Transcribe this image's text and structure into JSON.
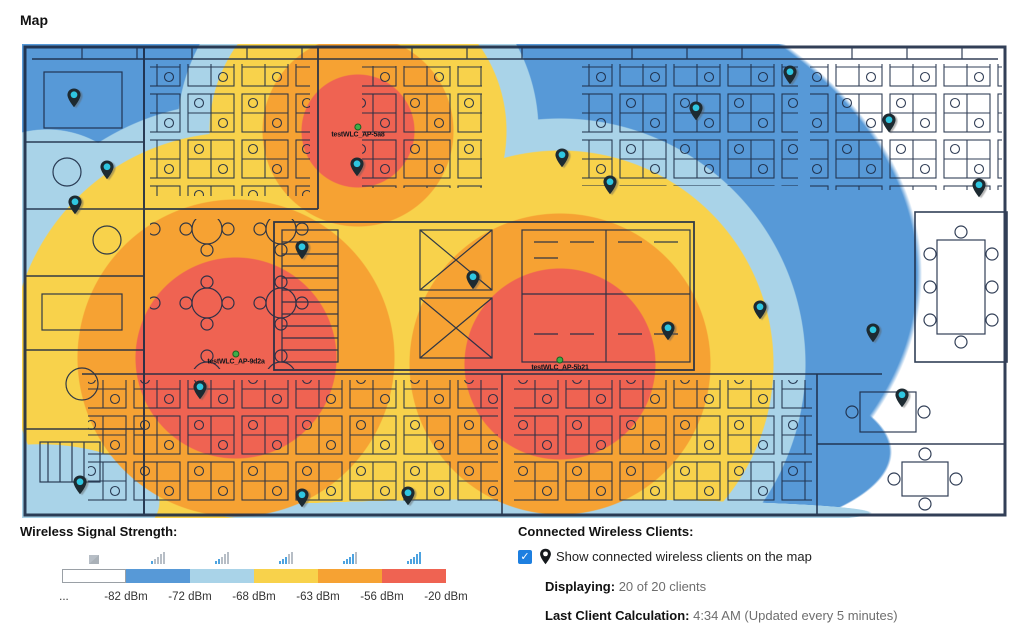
{
  "page": {
    "title": "Map"
  },
  "legend": {
    "title": "Wireless Signal Strength:",
    "leading_label": "...",
    "segments": [
      {
        "color": "#ffffff",
        "label": "-82 dBm",
        "bars": 0
      },
      {
        "color": "#5799d7",
        "label": "-72 dBm",
        "bars": 1
      },
      {
        "color": "#a9d3e8",
        "label": "-68 dBm",
        "bars": 2
      },
      {
        "color": "#f8d24b",
        "label": "-63 dBm",
        "bars": 3
      },
      {
        "color": "#f6a233",
        "label": "-56 dBm",
        "bars": 4
      },
      {
        "color": "#ef6352",
        "label": "-20 dBm",
        "bars": 5
      }
    ]
  },
  "clients_panel": {
    "title": "Connected Wireless Clients:",
    "checkbox_checked": true,
    "checkbox_glyph": "✓",
    "checkbox_label": "Show connected wireless clients on the map",
    "displaying_label": "Displaying:",
    "displaying_value": "20 of 20 clients",
    "last_calc_label": "Last Client Calculation:",
    "last_calc_value": "4:34 AM (Updated every 5 minutes)"
  },
  "map": {
    "heat_colors": {
      "blue": "#5799d7",
      "light_blue": "#a9d3e8",
      "yellow": "#f8d24b",
      "orange": "#f6a233",
      "red": "#ef6352"
    },
    "access_points": [
      {
        "name": "testWLC_AP-5a8",
        "x": 336,
        "y": 87
      },
      {
        "name": "testWLC_AP-9d2a",
        "x": 214,
        "y": 314
      },
      {
        "name": "testWLC_AP-5b21",
        "x": 538,
        "y": 320
      }
    ],
    "client_pins": [
      {
        "x": 52,
        "y": 56
      },
      {
        "x": 85,
        "y": 128
      },
      {
        "x": 53,
        "y": 163
      },
      {
        "x": 178,
        "y": 348
      },
      {
        "x": 58,
        "y": 443
      },
      {
        "x": 280,
        "y": 208
      },
      {
        "x": 335,
        "y": 125
      },
      {
        "x": 280,
        "y": 456
      },
      {
        "x": 386,
        "y": 454
      },
      {
        "x": 451,
        "y": 238
      },
      {
        "x": 540,
        "y": 116
      },
      {
        "x": 588,
        "y": 143
      },
      {
        "x": 646,
        "y": 289
      },
      {
        "x": 674,
        "y": 69
      },
      {
        "x": 738,
        "y": 268
      },
      {
        "x": 768,
        "y": 33
      },
      {
        "x": 851,
        "y": 291
      },
      {
        "x": 867,
        "y": 81
      },
      {
        "x": 880,
        "y": 356
      },
      {
        "x": 957,
        "y": 146
      }
    ]
  }
}
